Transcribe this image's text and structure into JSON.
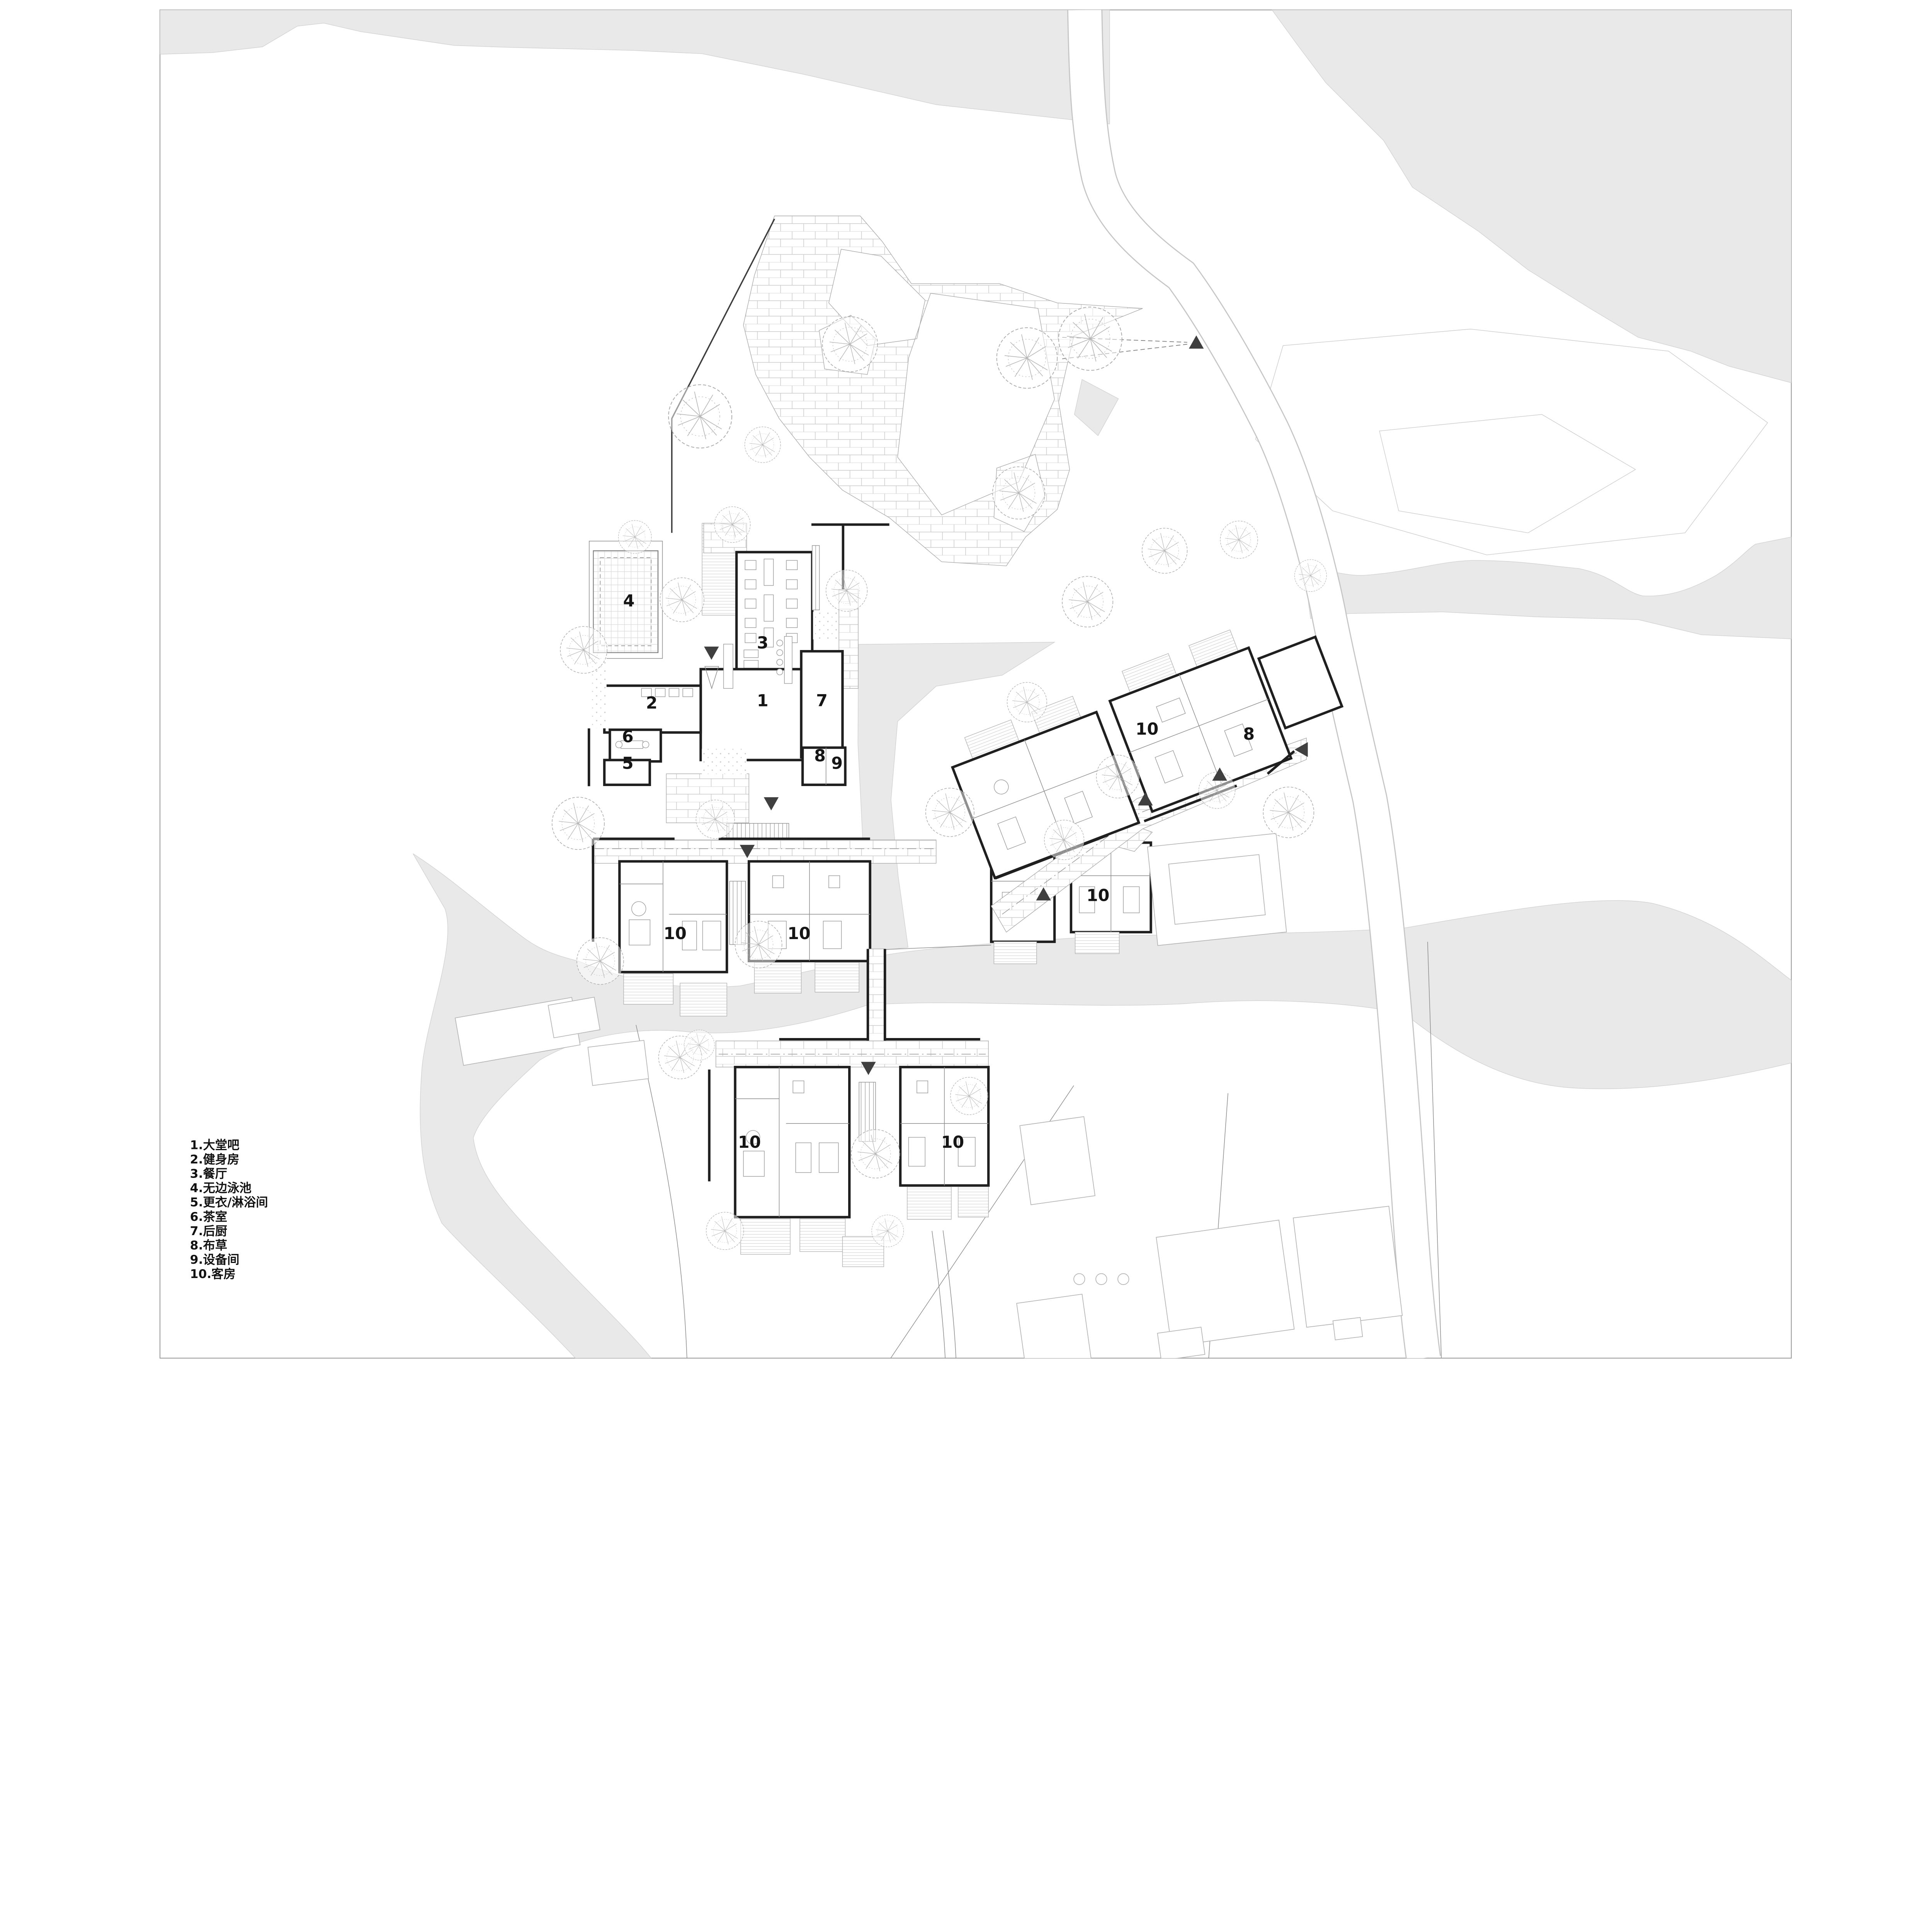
{
  "drawing": {
    "type": "resort-site-plan",
    "sheet_background": "#ffffff"
  },
  "legend": {
    "items": [
      "1.大堂吧",
      "2.健身房",
      "3.餐厅",
      "4.无边泳池",
      "5.更衣/淋浴间",
      "6.茶室",
      "7.后厨",
      "8.布草",
      "9.设备间",
      "10.客房"
    ]
  },
  "plan": {
    "labels": [
      {
        "id": "lobby-bar",
        "text": "1"
      },
      {
        "id": "gym",
        "text": "2"
      },
      {
        "id": "restaurant",
        "text": "3"
      },
      {
        "id": "infinity-pool",
        "text": "4"
      },
      {
        "id": "changing-shower",
        "text": "5"
      },
      {
        "id": "tea-room",
        "text": "6"
      },
      {
        "id": "back-kitchen",
        "text": "7"
      },
      {
        "id": "linen-main",
        "text": "8"
      },
      {
        "id": "equipment-room",
        "text": "9"
      },
      {
        "id": "guest-center-left",
        "text": "10"
      },
      {
        "id": "guest-center-right",
        "text": "10"
      },
      {
        "id": "guest-bottom-left",
        "text": "10"
      },
      {
        "id": "guest-bottom-right",
        "text": "10"
      },
      {
        "id": "guest-lower-right",
        "text": "10"
      },
      {
        "id": "guest-east",
        "text": "10"
      },
      {
        "id": "linen-east",
        "text": "8"
      }
    ]
  },
  "colors": {
    "water": "#e9e9ea",
    "wall": "#1f1f1f",
    "label": "#151515",
    "tree": "#ababab",
    "road_edge": "#c6c6c6",
    "neighbor_outline": "#b5b5b5",
    "marker": "#3f3f3f"
  }
}
